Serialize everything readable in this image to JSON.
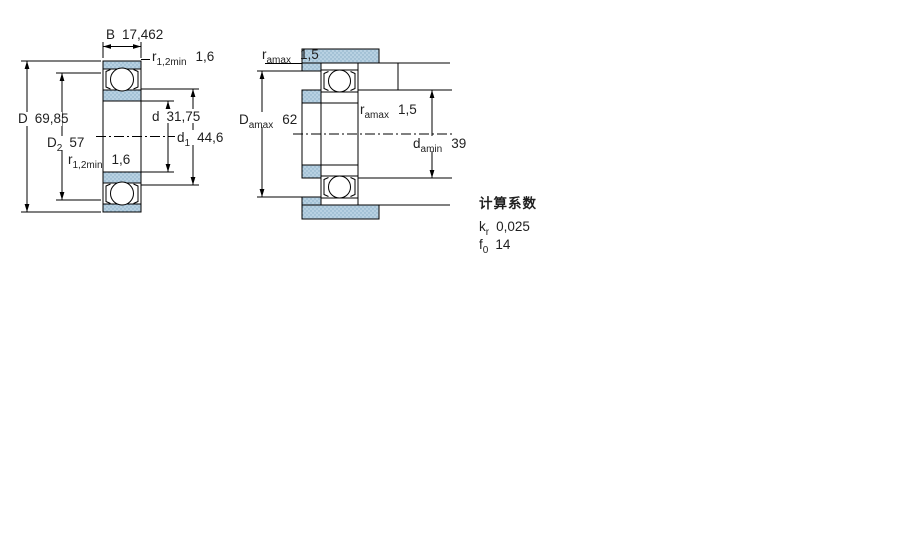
{
  "left_view": {
    "description": "bearing cross-section view",
    "dimensions": {
      "B": {
        "symbol": "B",
        "value": "17,462"
      },
      "r_top": {
        "symbol": "r",
        "sub": "1,2min",
        "value": "1,6"
      },
      "D": {
        "symbol": "D",
        "value": "69,85"
      },
      "D2": {
        "symbol": "D",
        "sub": "2",
        "value": "57"
      },
      "d": {
        "symbol": "d",
        "value": "31,75"
      },
      "d1": {
        "symbol": "d",
        "sub": "1",
        "value": "44,6"
      },
      "r_bottom": {
        "symbol": "r",
        "sub": "1,2min",
        "value": "1,6"
      }
    }
  },
  "right_view": {
    "description": "abutment and fillet dimensions view",
    "dimensions": {
      "ra_top": {
        "symbol": "r",
        "sub": "amax",
        "value": "1,5"
      },
      "Da": {
        "symbol": "D",
        "sub": "amax",
        "value": "62"
      },
      "ra_mid": {
        "symbol": "r",
        "sub": "amax",
        "value": "1,5"
      },
      "da": {
        "symbol": "d",
        "sub": "amin",
        "value": "39"
      }
    }
  },
  "calculation_factors": {
    "title": "计算系数",
    "rows": [
      {
        "symbol": "k",
        "sub": "r",
        "value": "0,025"
      },
      {
        "symbol": "f",
        "sub": "0",
        "value": "14"
      }
    ]
  },
  "colors": {
    "hatch_fill": "#b8d1e2",
    "hatch_dot": "#86abc4",
    "line": "#000000",
    "text": "#1f1f1f"
  }
}
